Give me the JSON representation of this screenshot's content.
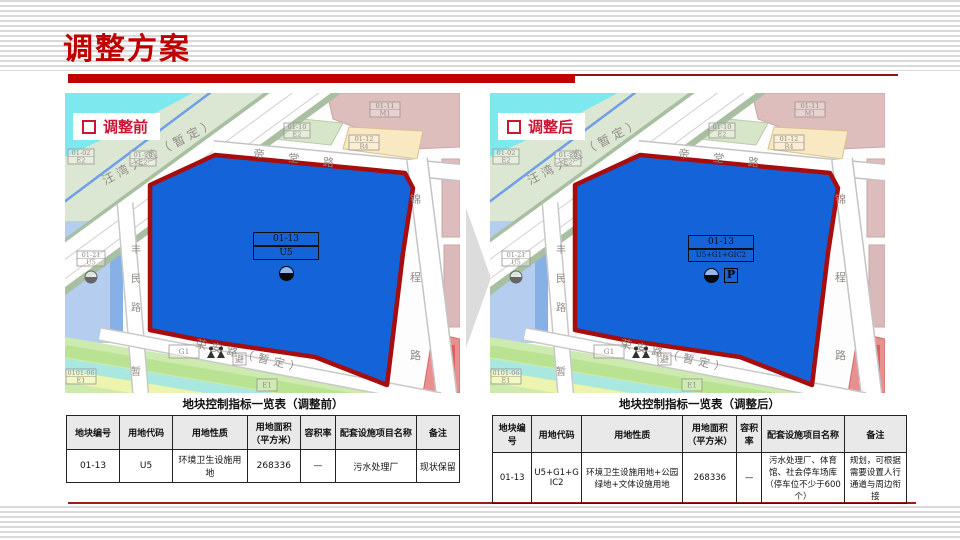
{
  "slide": {
    "title": "调整方案"
  },
  "panels": [
    {
      "tag": "调整前",
      "table_title": "地块控制指标一览表（调整前）",
      "parcel_code": "01-13",
      "parcel_use": "U5",
      "row": [
        "01-13",
        "U5",
        "环境卫生设施用地",
        "268336",
        "—",
        "污水处理厂",
        "现状保留"
      ]
    },
    {
      "tag": "调整后",
      "table_title": "地块控制指标一览表（调整后）",
      "parcel_code": "01-13",
      "parcel_use": "U5+G1+GIC2",
      "parking": "P",
      "row": [
        "01-13",
        "U5+G1+GIC2",
        "环境卫生设施用地+公园绿地+文体设施用地",
        "268336",
        "—",
        "污水处理厂、体育馆、社会停车场库（停车位不少于600个）",
        "规划，可根据需要设置人行通道与周边衔接"
      ]
    }
  ],
  "table": {
    "headers": [
      "地块编号",
      "用地代码",
      "用地性质",
      "用地面积（平方米）",
      "容积率",
      "配套设施项目名称",
      "备注"
    ]
  },
  "map": {
    "road_wangwan": "汪湾大道（暂定）",
    "road_ditang": "帝堂路",
    "road_jincheng": "锦程路",
    "road_fengmin": "丰民路",
    "road_rongan": "荣安路（暂定）",
    "zan": "暂",
    "bi": "避",
    "p0102_code": "01-02",
    "p0102_use": "E2",
    "p0120_code": "01-20",
    "p0120_use": "E2",
    "p0110_code": "01-10",
    "p0110_use": "E2",
    "p0111_code": "01-11",
    "p0111_use": "M1",
    "p0112_code": "01-12",
    "p0112_use": "R4",
    "p0121_code": "01-21",
    "p0121_use": "U5",
    "p010106_code": "0101-06",
    "p010106_use": "E1",
    "g1": "G1",
    "e1": "E1"
  },
  "colors": {
    "accent_red": "#c00000",
    "tag_red": "#cc1433",
    "parcel_blue": "#1463d9",
    "parcel_border_red": "#a80d0d"
  }
}
